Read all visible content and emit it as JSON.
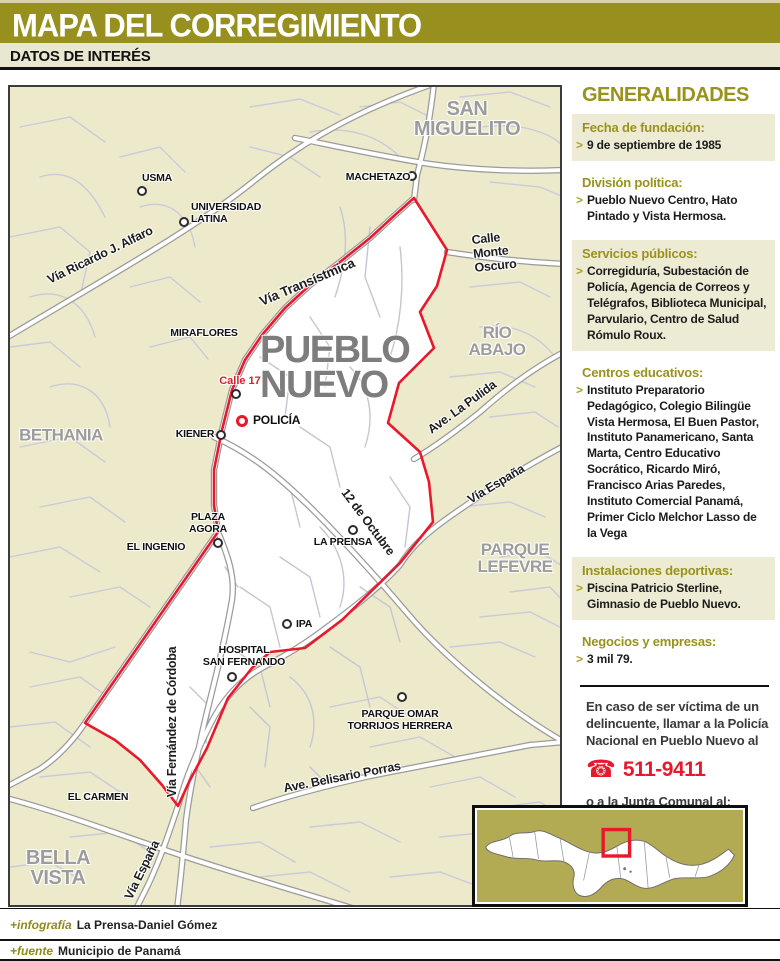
{
  "header": {
    "title": "MAPA DEL CORREGIMIENTO",
    "subtitle": "DATOS DE INTERÉS"
  },
  "map": {
    "area_title": "PUEBLO\nNUEVO",
    "districts": {
      "san_miguelito": "SAN MIGUELITO",
      "rio_abajo": "RÍO ABAJO",
      "bethania": "BETHANIA",
      "parque_lefevre": "PARQUE\nLEFEVRE",
      "bella_vista": "BELLA\nVISTA"
    },
    "roads": {
      "alfaro": "Vía Ricardo J. Alfaro",
      "transistmica": "Vía Transístmica",
      "monte_oscuro": "Calle Monte Oscuro",
      "la_pulida": "Ave. La Pulida",
      "espana": "Vía España",
      "doce_octubre": "12 de Octubre",
      "cordoba": "Vía Fernández de Córdoba",
      "belisario": "Ave. Belisario Porras",
      "calle17": "Calle 17"
    },
    "pois": {
      "usma": "USMA",
      "universidad": "UNIVERSIDAD\nLATINA",
      "machetazo": "MACHETAZO",
      "miraflores": "MIRAFLORES",
      "policia": "POLICÍA",
      "kiener": "KIENER",
      "plaza_agora": "PLAZA\nAGORA",
      "el_ingenio": "EL INGENIO",
      "la_prensa": "LA PRENSA",
      "ipa": "IPA",
      "hospital": "HOSPITAL\nSAN FERNANDO",
      "parque_omar": "PARQUE OMAR\nTORRIJOS HERRERA",
      "el_carmen": "EL CARMEN"
    }
  },
  "sidebar": {
    "title": "GENERALIDADES",
    "bullet": ">",
    "sections": [
      {
        "heading": "Fecha de fundación:",
        "text": "9 de septiembre de 1985"
      },
      {
        "heading": "División política:",
        "text": "Pueblo Nuevo Centro, Hato Pintado y Vista Hermosa."
      },
      {
        "heading": "Servicios públicos:",
        "text": "Corregiduría, Subestación de Policía, Agencia de Correos y Telégrafos, Biblioteca Municipal, Parvulario, Centro de Salud Rómulo Roux."
      },
      {
        "heading": "Centros educativos:",
        "text": "Instituto Preparatorio Pedagógico, Colegio Bilingüe Vista Hermosa, El Buen Pastor, Instituto Panamericano, Santa Marta, Centro Educativo Socrático, Ricardo Miró, Francisco Arias Paredes, Instituto Comercial Panamá, Primer Ciclo Melchor Lasso de la Vega"
      },
      {
        "heading": "Instalaciones deportivas:",
        "text": "Piscina Patricio Sterline, Gimnasio de Pueblo Nuevo."
      },
      {
        "heading": "Negocios y empresas:",
        "text": "3 mil 79."
      }
    ],
    "emergency": {
      "line1": "En caso de ser víctima de un delincuente, llamar a la Policía Nacional en Pueblo Nuevo al",
      "phone_icon": "☎",
      "phone1": "511-9411",
      "line2": "o a la Junta Comunal al:",
      "phone2": "506-8047"
    }
  },
  "footer": {
    "credit1_label": "+infografía",
    "credit1_value": "La Prensa-Daniel Gómez",
    "credit2_label": "+fuente",
    "credit2_value": "Municipio de Panamá"
  },
  "colors": {
    "olive": "#97901F",
    "cream": "#EAE7D0",
    "map_khaki": "#ECEACB",
    "boundary_red": "#E8192C",
    "district_gray": "#9C9C9C",
    "inset_olive": "#B3AA54"
  }
}
